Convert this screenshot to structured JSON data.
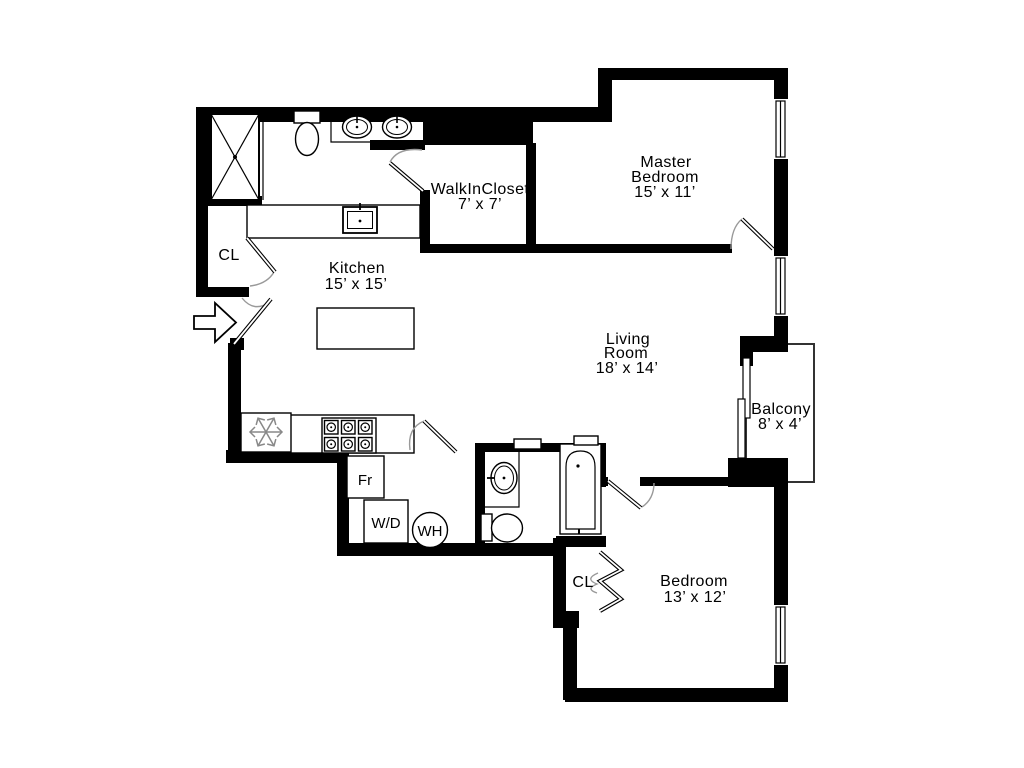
{
  "diagram": {
    "type": "apartment-floor-plan",
    "background_color": "#ffffff",
    "wall_color": "#000000",
    "door_arc_color": "#999999",
    "rooms": {
      "master_bedroom": {
        "name_line1": "Master",
        "name_line2": "Bedroom",
        "dims": "15’ x 11’"
      },
      "walk_in_closet": {
        "name_line1": "WalkInCloset",
        "dims": "7’ x 7’"
      },
      "kitchen": {
        "name_line1": "Kitchen",
        "dims": "15’ x 15’"
      },
      "living_room": {
        "name_line1": "Living",
        "name_line2": "Room",
        "dims": "18’ x 14’"
      },
      "balcony": {
        "name_line1": "Balcony",
        "dims": "8’ x 4’"
      },
      "bedroom": {
        "name_line1": "Bedroom",
        "dims": "13’ x 12’"
      }
    },
    "closets": {
      "entry_closet": "CL",
      "bedroom_closet": "CL"
    },
    "appliances": {
      "refrigerator": "Fr",
      "washer_dryer": "W/D",
      "water_heater": "WH"
    }
  }
}
